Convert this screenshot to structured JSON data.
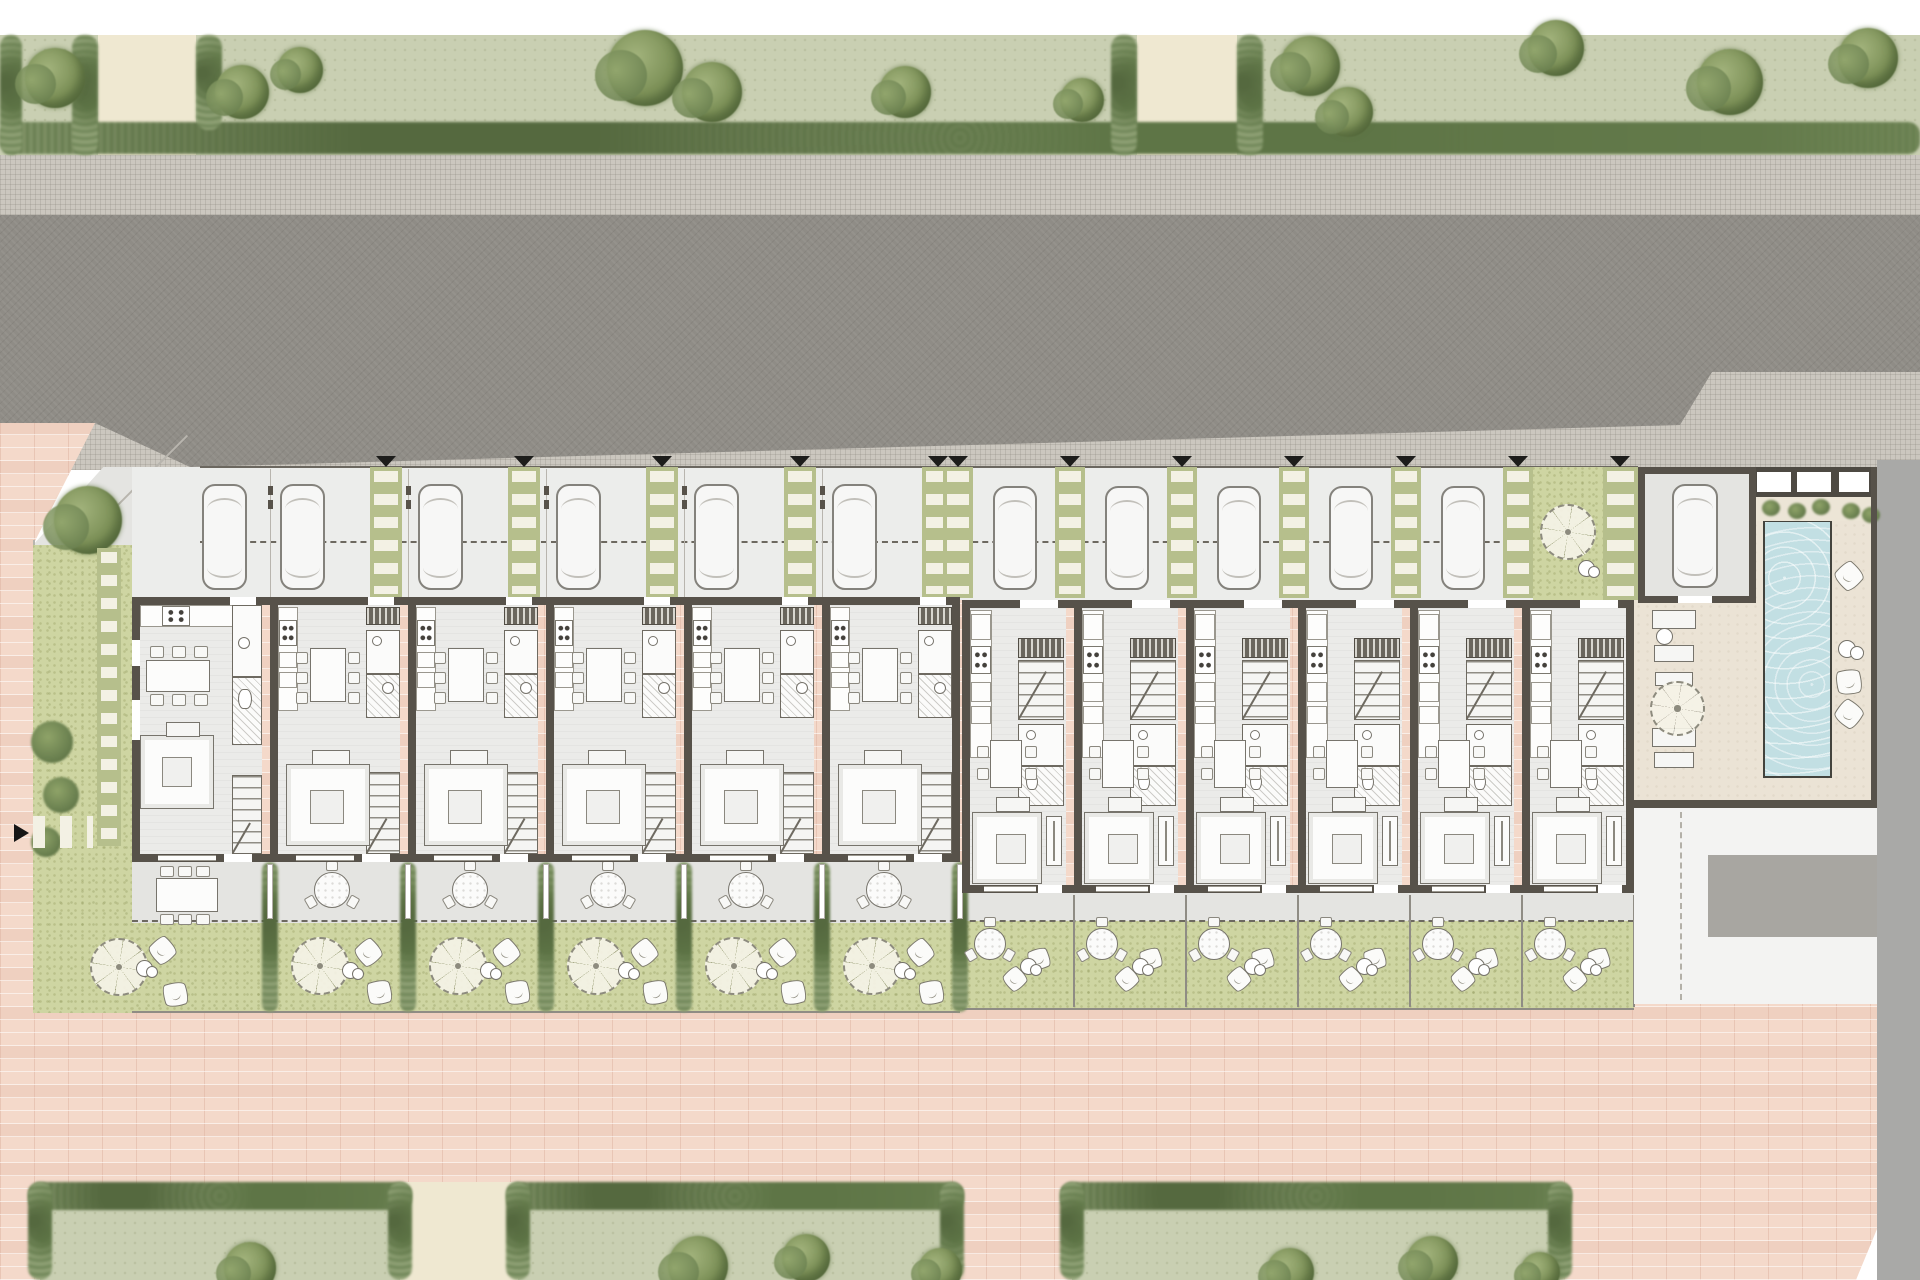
{
  "labels": {
    "pedestrian_street": "PEATONAL"
  },
  "summary": {
    "residential_units": 12,
    "type_a_units": 6,
    "type_b_units": 6,
    "parked_cars": 12,
    "pools": 1
  },
  "colors": {
    "wall": "#57524a",
    "road": "#8f8c86",
    "sidewalk": "#cbc7bf",
    "plaza": "#f4d9ca",
    "lawn": "#ced5a2",
    "grass": "#c9cfb2",
    "hedge": "#7f956a",
    "tree": "#7d9158",
    "path": "#efe8d1",
    "floor": "#ebebe9",
    "concrete": "#e4e4e1",
    "deck": "#ebe3d5",
    "pool": "#c2dfe3",
    "paver": "#b6bf8c",
    "slat": "#f3f1e4",
    "marker": "#1d1d1b",
    "pad": "#a8a6a1",
    "neighbor": "#a9a9a7",
    "furn": "#77746c"
  },
  "plan": {
    "canvas": {
      "w": 1920,
      "h": 1280
    },
    "green_band": {
      "rect": [
        0,
        35,
        1920,
        120
      ],
      "hedge_row": [
        0,
        122,
        1920,
        32
      ],
      "paths": [
        [
          98,
          35,
          98,
          120
        ],
        [
          1137,
          35,
          100,
          120
        ]
      ],
      "hedges_v": [
        [
          72,
          35,
          26,
          120
        ],
        [
          196,
          35,
          26,
          95
        ],
        [
          1111,
          35,
          26,
          120
        ],
        [
          1237,
          35,
          26,
          120
        ],
        [
          0,
          35,
          22,
          120
        ]
      ],
      "trees": [
        [
          55,
          78,
          30
        ],
        [
          242,
          92,
          27
        ],
        [
          300,
          70,
          23
        ],
        [
          645,
          68,
          38
        ],
        [
          712,
          92,
          30
        ],
        [
          905,
          92,
          26
        ],
        [
          1082,
          100,
          22
        ],
        [
          1310,
          66,
          30
        ],
        [
          1348,
          112,
          25
        ],
        [
          1556,
          48,
          28
        ],
        [
          1730,
          82,
          33
        ],
        [
          1868,
          58,
          30
        ]
      ]
    },
    "sidewalk": [
      0,
      155,
      1920,
      315
    ],
    "road": {
      "rect": [
        0,
        215,
        1920,
        255
      ],
      "poly": [
        [
          0,
          0
        ],
        [
          1920,
          0
        ],
        [
          1920,
          157
        ],
        [
          1712,
          157
        ],
        [
          1680,
          210
        ],
        [
          190,
          252
        ],
        [
          95,
          208
        ],
        [
          0,
          208
        ]
      ]
    },
    "plaza": {
      "rect": [
        0,
        423,
        1877,
        857
      ],
      "poly": [
        [
          0,
          0
        ],
        [
          95,
          0
        ],
        [
          33,
          122
        ],
        [
          1877,
          122
        ],
        [
          1877,
          806
        ],
        [
          1856,
          857
        ],
        [
          0,
          857
        ]
      ],
      "label_pos": [
        858,
        1068
      ]
    },
    "bottom_band": {
      "plots": [
        [
          40,
          1182,
          360,
          98
        ],
        [
          518,
          1182,
          434,
          98
        ],
        [
          1072,
          1182,
          488,
          98
        ]
      ],
      "paths": [
        [
          400,
          1182,
          118,
          98
        ]
      ],
      "trees": [
        [
          250,
          1268,
          26
        ],
        [
          698,
          1266,
          30
        ],
        [
          806,
          1258,
          24
        ],
        [
          940,
          1270,
          22
        ],
        [
          1290,
          1272,
          24
        ],
        [
          1432,
          1262,
          26
        ],
        [
          1540,
          1272,
          20
        ]
      ]
    },
    "parking": {
      "rect": [
        132,
        467,
        1506,
        133
      ],
      "dash_y": 541,
      "boundary_line_y": 466
    },
    "units_a": {
      "x0": 132,
      "pitch": 138,
      "count": 6,
      "bld_y": 597,
      "bld_h": 265,
      "terrace": [
        132,
        862,
        828,
        61
      ],
      "lawn": [
        132,
        923,
        828,
        88
      ],
      "fence_y": 1011,
      "dividers": [
        270,
        408,
        546,
        684,
        822,
        960
      ]
    },
    "units_b": {
      "x0": 962,
      "pitch": 112,
      "count": 6,
      "bld_y": 600,
      "bld_h": 293,
      "terrace": [
        962,
        893,
        672,
        28
      ],
      "lawn": [
        962,
        921,
        672,
        89
      ],
      "fence_y": 1008,
      "dividers": [
        1074,
        1186,
        1298,
        1410,
        1522,
        1634
      ]
    },
    "dash_line": [
      132,
      920,
      1502
    ],
    "west": {
      "corner_terrace": [
        33,
        467,
        227,
        78
      ],
      "boundary_diag": [
        103,
        470,
        99,
        135
      ],
      "boundary_v": [
        33,
        540,
        2,
        473
      ],
      "lawn": [
        33,
        545,
        99,
        468
      ],
      "front_lawn": [
        121,
        558,
        77,
        39
      ],
      "tree": [
        88,
        520,
        34
      ],
      "shrubs": [
        [
          52,
          742,
          21
        ],
        [
          61,
          795,
          18
        ],
        [
          46,
          842,
          15
        ]
      ],
      "step_col": [
        97,
        548,
        24,
        298
      ],
      "h_slats": [
        33,
        816,
        60,
        32
      ],
      "arrow": [
        14,
        824
      ]
    },
    "community": {
      "deck": [
        1634,
        467,
        243,
        340
      ],
      "slat_strip": [
        1603,
        467,
        35,
        133
      ],
      "b6_lawn": [
        1533,
        467,
        70,
        133
      ],
      "b6_parasol": [
        1540,
        504,
        56
      ],
      "garage": [
        1638,
        467,
        118,
        136
      ],
      "garage_car": [
        1672,
        484,
        46,
        104
      ],
      "skylight": [
        1750,
        467,
        127,
        30
      ],
      "planter": [
        1750,
        497,
        127,
        24
      ],
      "plants": [
        [
          1762,
          500
        ],
        [
          1788,
          503
        ],
        [
          1812,
          499
        ],
        [
          1842,
          503
        ],
        [
          1862,
          507
        ]
      ],
      "pool": [
        1763,
        520,
        69,
        258
      ],
      "loungers": [
        [
          1652,
          610,
          44,
          19
        ],
        [
          1654,
          645,
          40,
          17
        ],
        [
          1655,
          672,
          38,
          14
        ],
        [
          1652,
          728,
          44,
          19
        ],
        [
          1654,
          752,
          40,
          16
        ]
      ],
      "parasol": [
        1650,
        681,
        55
      ],
      "side_circle": [
        1656,
        628,
        17
      ],
      "cushions": [
        [
          1836,
          563,
          26,
          40
        ],
        [
          1836,
          669,
          26,
          -15
        ],
        [
          1836,
          701,
          26,
          30
        ]
      ],
      "pair_circles": [
        1838,
        640
      ],
      "bottom_wall": [
        1634,
        800,
        243,
        8
      ],
      "courtyard": [
        1634,
        808,
        243,
        196
      ],
      "pad": [
        1708,
        855,
        169,
        82
      ],
      "dash_x": 1680
    },
    "gray_margin": [
      1877,
      460,
      43,
      820
    ],
    "triangles_a": [
      386,
      524,
      662,
      800,
      938
    ],
    "triangles_b": [
      958,
      1070,
      1182,
      1294,
      1406,
      1518,
      1620
    ]
  }
}
